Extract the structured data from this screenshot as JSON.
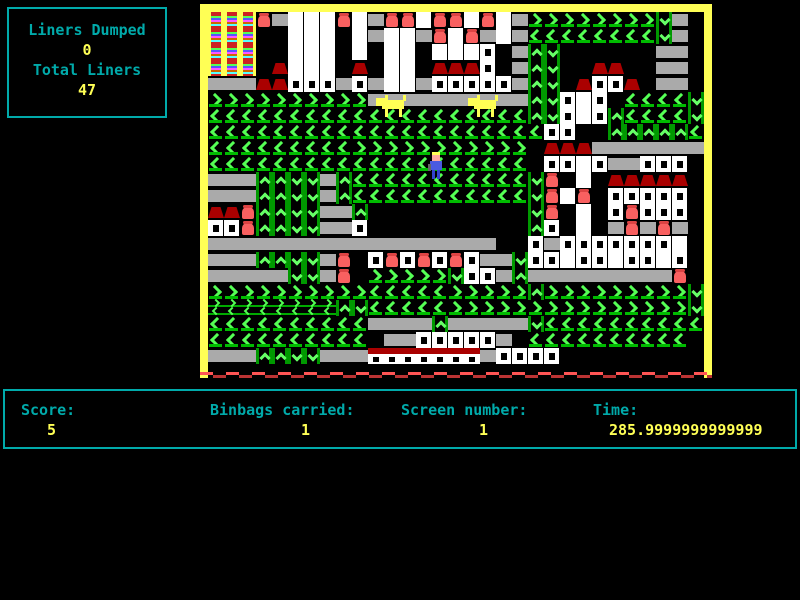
{
  "hud": {
    "liners_dumped_label": "Liners Dumped",
    "liners_dumped_value": "0",
    "total_liners_label": "Total Liners",
    "total_liners_value": "47"
  },
  "status_bar": {
    "score_label": "Score:",
    "score_value": "5",
    "binbags_label": "Binbags carried:",
    "binbags_value": "1",
    "screen_label": "Screen number:",
    "screen_value": "1",
    "time_label": "Time:",
    "time_value": "285.9999999999999"
  },
  "colors": {
    "hud_label": "#00AAAA",
    "hud_value": "#FFFF55",
    "panel_border": "#00AAAA",
    "game_border": "#FFFF55",
    "conveyor_green": "#55FF55",
    "conveyor_rail_green": "#00AA00",
    "platform_gray": "#AAAAAA",
    "building_white": "#FFFFFF",
    "roof_dark_red": "#AA0000",
    "bin_red": "#F96060",
    "dog_yellow": "#FFFF55",
    "bottom_edge_red": "#FF5555"
  },
  "game": {
    "tile_size": 16,
    "grid_cols": 31,
    "grid_rows": 22,
    "legend": {
      ">": "conveyor-right",
      "<": "conveyor-left",
      "^": "ladder-up",
      "v": "ladder-down",
      "=": "platform",
      "W": "building-window",
      "w": "building-plain",
      "R": "roof",
      "B": "bin",
      "Y": "tower-rainbow",
      "z": "conveyor-mini-double",
      "H": "house-strip",
      ".": "empty"
    },
    "tile_map": [
      "YYYB=wwwBw=BBwBBwBw=>>>>>>>>v=.",
      "YYY..www.w=ww=BwB=w=<<<<<<<<v=.",
      "YYY..www.w.ww.wwwW.=^v......==.",
      "YYY.Rwww.R.ww.RRRW.=^v..RR..==.",
      "===RRWWW=W=ww=WWWWW=^v.RWWR.==.",
      ">>>>>>>>>>==========^vWwW.<<<<v",
      "<<<<<<<<<<<<<<<<<<<<^vWwW^<<<<v",
      "<<<<<<<<<<<<<<<<<<<<<WW..^^^^^<",
      "<<<<<<<<<>>>>>>>>>>>.RRR=======",
      "<<<<<<<<<<<<<<<<<<<<.WWwW==WWW.",
      "===^^vv=^<<<<<<<<<<<vB.w.RRRRR.",
      "===^^vv=^<<<<<<<<<<<vBwB.WWWWW.",
      "RRB^^vv==^..........vB.w.WBWWW.",
      "WWB^^vv==W..........^W.w.=B=B=.",
      "==================..W=WWWWWWWw.",
      "===^^vv=B.WBWBWBW==vWWwWWwWWwW.",
      "=====vv=B.>>>>>vWW=^=========B.",
      ">>>>>>>>>><<<<<>>>>>^>>>>>>>>>v",
      "zzzzzzzz^v<<<<<>>>>>>>>>>>>>>>v",
      "<<<<<<<<<<====^=====v<<<<<<<<<<",
      "<<<<<<<<<<.==WWWWW=.<<<<<<<<<<.",
      "===^^vv===HHHHHHH=WWWW........."
    ],
    "sprites": {
      "player": {
        "x": 220,
        "y": 140
      },
      "dogs": [
        {
          "x": 168,
          "y": 82
        },
        {
          "x": 260,
          "y": 82
        }
      ]
    }
  }
}
